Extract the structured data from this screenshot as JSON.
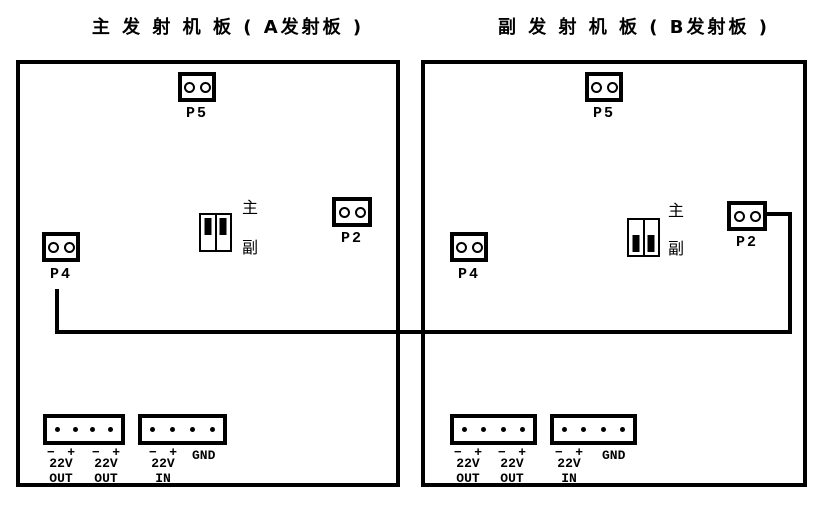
{
  "boards": [
    {
      "title": "主 发 射 机 板 ( A发射板 )",
      "p5_label": "P5",
      "p2_label": "P2",
      "p4_label": "P4",
      "jumper": {
        "main_label": "主",
        "sub_label": "副",
        "position": "top"
      },
      "power_columns": [
        {
          "minus": "−",
          "plus": "+",
          "volt": "22V",
          "dir": "OUT"
        },
        {
          "minus": "−",
          "plus": "+",
          "volt": "22V",
          "dir": "OUT"
        },
        {
          "minus": "−",
          "plus": "+",
          "volt": "22V",
          "dir": "IN"
        }
      ],
      "gnd_label": "GND"
    },
    {
      "title": "副 发 射 机 板 ( B发射板 )",
      "p5_label": "P5",
      "p2_label": "P2",
      "p4_label": "P4",
      "jumper": {
        "main_label": "主",
        "sub_label": "副",
        "position": "bottom"
      },
      "power_columns": [
        {
          "minus": "−",
          "plus": "+",
          "volt": "22V",
          "dir": "OUT"
        },
        {
          "minus": "−",
          "plus": "+",
          "volt": "22V",
          "dir": "OUT"
        },
        {
          "minus": "−",
          "plus": "+",
          "volt": "22V",
          "dir": "IN"
        }
      ],
      "gnd_label": "GND"
    }
  ],
  "colors": {
    "line": "#000000",
    "background": "#ffffff"
  }
}
